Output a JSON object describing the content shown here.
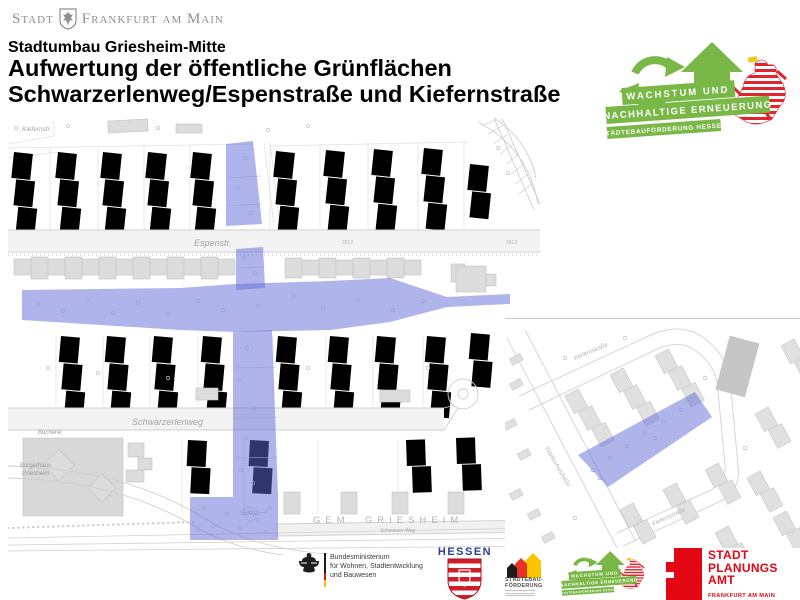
{
  "header": {
    "city_brand": {
      "stadt": "Stadt",
      "frankfurt": "Frankfurt am Main"
    },
    "subtitle": "Stadtumbau Griesheim-Mitte",
    "title_line1": "Aufwertung der öffentliche Grünflächen",
    "title_line2": "Schwarzerlenweg/Espenstraße und Kiefernstraße"
  },
  "program_logo": {
    "banner1": "WACHSTUM UND",
    "banner2": "NACHHALTIGE ERNEUERUNG",
    "banner3": "STÄDTEBAUFÖRDERUNG HESSEN",
    "green": "#79b747",
    "lion_red": "#e2242c"
  },
  "map": {
    "highlight_color": "#5f6cd8",
    "labels": {
      "kiefernstr_top": "Kiefernstr.",
      "espenstr": "Espenstr.",
      "parcel_2612": "2612",
      "parcel_2613": "2613",
      "schwarzerlenweg": "Schwarzerlenweg",
      "buecherei": "Bücherei",
      "buergerhaus1": "Bürgerhaus",
      "buergerhaus2": "Griesheim",
      "spielplatz": "Spielpl.",
      "gemarkung": "GEM. GRIESHEIM",
      "schwarzer_weg": "Schwarzer Weg"
    },
    "inset_labels": {
      "kiefernstrasse_top": "Kiefernstraße",
      "waldschulstrasse": "Waldschulstraße",
      "kiefernstrasse_bottom": "Kiefernstraße"
    }
  },
  "footer": {
    "bund": {
      "line1": "Bundesministerium",
      "line2": "für Wohnen, Stadtentwicklung",
      "line3": "und Bauwesen"
    },
    "hessen": {
      "wordmark": "HESSEN"
    },
    "staedtebau": {
      "line1": "STÄDTEBAU-",
      "line2": "FÖRDERUNG"
    },
    "planungsamt": {
      "line1": "STADT",
      "line2": "PLANUNGS",
      "line3": "AMT",
      "line4": "FRANKFURT AM MAIN",
      "red": "#e30613"
    }
  }
}
